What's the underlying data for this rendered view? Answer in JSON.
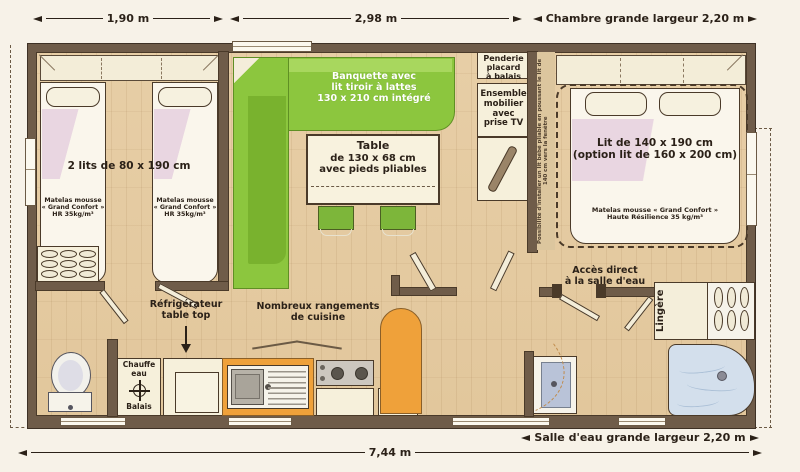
{
  "colors": {
    "wall_brown": "#6f5c49",
    "banquette_green": "#8cc63e",
    "kitchen_orange": "#efa13a",
    "shower_blue": "#d3dfec",
    "floor_wood": "#e5cba1"
  },
  "dims": {
    "w190": "1,90 m",
    "w298": "2,98 m",
    "chambre": "Chambre grande largeur 2,20 m",
    "salle": "Salle d'eau grande largeur 2,20 m",
    "total": "7,44 m"
  },
  "left_bedroom": {
    "beds": "2 lits de 80 x 190 cm",
    "mattress": [
      "Matelas mousse",
      "« Grand Confort »",
      "HR 35kg/m³"
    ]
  },
  "living": {
    "banquette": [
      "Banquette avec",
      "lit tiroir à lattes",
      "130 x 210 cm intégré"
    ],
    "table": [
      "Table",
      "de 130 x 68 cm",
      "avec pieds pliables"
    ]
  },
  "storage": {
    "penderie": [
      "Penderie",
      "placard",
      "à balais"
    ],
    "ensemble": [
      "Ensemble",
      "mobilier",
      "avec",
      "prise TV"
    ]
  },
  "right_bedroom": {
    "bed": [
      "Lit de 140 x 190 cm",
      "(option lit de 160 x 200 cm)"
    ],
    "mattress": [
      "Matelas mousse « Grand Confort »",
      "Haute Résilience 35 kg/m³"
    ],
    "note": "Possibilité d'installer un lit bébé pliable en poussant le lit de 140 cm vers la fenêtre"
  },
  "bathroom": {
    "acces": [
      "Accès direct",
      "à la salle d'eau"
    ],
    "lingere": "Lingère"
  },
  "kitchen": {
    "fridge": [
      "Réfrigérateur",
      "table top"
    ],
    "rangements": [
      "Nombreux rangements",
      "de cuisine"
    ],
    "chauffe": [
      "Chauffe",
      "eau"
    ],
    "balais": "Balais"
  }
}
